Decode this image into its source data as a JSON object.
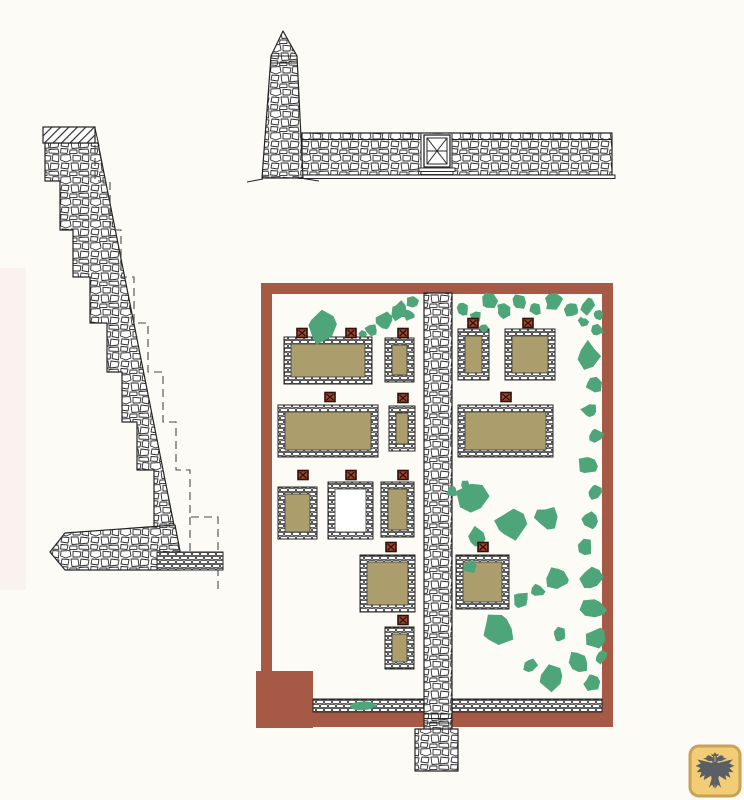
{
  "document": {
    "type": "archaeological measured drawing: walled garden site plan with wall elevation and stepped wall section",
    "visible_text": []
  },
  "colors": {
    "background": "#fcfbf5",
    "paper_tint_strip": "#f9f2ef",
    "line": "#242424",
    "perimeter_wall_red": "#a65a45",
    "building_fill_tan": "#ab9e6c",
    "building_fill_open": "#ffffff",
    "vegetation_green": "#4ea57a",
    "marker_fill": "#9e4730",
    "marker_border": "#30100a",
    "badge_fill": "#f2cd75",
    "badge_border": "#c7a258",
    "eagle": "#5a5f66",
    "dashed_line": "#4a4a4a"
  },
  "plan": {
    "perimeter": {
      "x0": 261,
      "y0": 283,
      "x1": 613,
      "y1": 727,
      "band": 11,
      "bottom_band": 15
    },
    "bastion": {
      "x": 256,
      "y": 671,
      "w": 57,
      "h": 57
    },
    "central_wall": {
      "x": 424,
      "y": 293,
      "w": 28,
      "h": 437
    },
    "wall_footing": {
      "x": 415,
      "y": 729,
      "w": 43,
      "h": 42
    },
    "bottom_strips": [
      {
        "x": 313,
        "y": 699,
        "w": 111,
        "h": 13
      },
      {
        "x": 452,
        "y": 699,
        "w": 150,
        "h": 13
      }
    ],
    "buildings": [
      {
        "x": 284,
        "y": 337,
        "w": 88,
        "h": 47,
        "fill": "tan"
      },
      {
        "x": 385,
        "y": 338,
        "w": 29,
        "h": 44,
        "fill": "tan"
      },
      {
        "x": 278,
        "y": 405,
        "w": 100,
        "h": 52,
        "fill": "tan"
      },
      {
        "x": 389,
        "y": 406,
        "w": 26,
        "h": 45,
        "fill": "tan"
      },
      {
        "x": 278,
        "y": 487,
        "w": 39,
        "h": 52,
        "fill": "tan"
      },
      {
        "x": 328,
        "y": 482,
        "w": 45,
        "h": 57,
        "fill": "open"
      },
      {
        "x": 381,
        "y": 482,
        "w": 33,
        "h": 55,
        "fill": "tan"
      },
      {
        "x": 360,
        "y": 555,
        "w": 55,
        "h": 57,
        "fill": "tan"
      },
      {
        "x": 385,
        "y": 627,
        "w": 29,
        "h": 42,
        "fill": "tan"
      },
      {
        "x": 458,
        "y": 329,
        "w": 31,
        "h": 51,
        "fill": "tan"
      },
      {
        "x": 505,
        "y": 329,
        "w": 50,
        "h": 51,
        "fill": "tan"
      },
      {
        "x": 458,
        "y": 405,
        "w": 95,
        "h": 52,
        "fill": "tan"
      },
      {
        "x": 456,
        "y": 555,
        "w": 53,
        "h": 54,
        "fill": "tan"
      }
    ],
    "markers": [
      [
        302,
        333
      ],
      [
        351,
        333
      ],
      [
        403,
        333
      ],
      [
        473,
        323
      ],
      [
        528,
        323
      ],
      [
        330,
        397
      ],
      [
        403,
        398
      ],
      [
        506,
        397
      ],
      [
        303,
        475
      ],
      [
        351,
        475
      ],
      [
        403,
        475
      ],
      [
        391,
        547
      ],
      [
        483,
        547
      ],
      [
        403,
        620
      ]
    ],
    "vegetation": [
      [
        321,
        327,
        15,
        1
      ],
      [
        371,
        330,
        6,
        2
      ],
      [
        384,
        321,
        10,
        3
      ],
      [
        400,
        311,
        9,
        4
      ],
      [
        412,
        301,
        6,
        5
      ],
      [
        363,
        334,
        4,
        6
      ],
      [
        409,
        315,
        6,
        7
      ],
      [
        463,
        309,
        6,
        8
      ],
      [
        476,
        318,
        6,
        9
      ],
      [
        489,
        302,
        8,
        10
      ],
      [
        503,
        311,
        7,
        11
      ],
      [
        484,
        328,
        5,
        12
      ],
      [
        519,
        301,
        9,
        13
      ],
      [
        536,
        308,
        6,
        14
      ],
      [
        553,
        301,
        9,
        15
      ],
      [
        571,
        310,
        7,
        16
      ],
      [
        588,
        306,
        8,
        17
      ],
      [
        599,
        315,
        5,
        18
      ],
      [
        583,
        322,
        5,
        19
      ],
      [
        597,
        331,
        6,
        20
      ],
      [
        588,
        356,
        13,
        21
      ],
      [
        594,
        384,
        9,
        22
      ],
      [
        590,
        411,
        8,
        23
      ],
      [
        596,
        435,
        7,
        24
      ],
      [
        588,
        465,
        9,
        25
      ],
      [
        595,
        493,
        7,
        26
      ],
      [
        591,
        520,
        8,
        27
      ],
      [
        585,
        547,
        8,
        28
      ],
      [
        472,
        500,
        15,
        29
      ],
      [
        511,
        523,
        15,
        30
      ],
      [
        547,
        518,
        11,
        31
      ],
      [
        477,
        538,
        10,
        32
      ],
      [
        452,
        492,
        6,
        33
      ],
      [
        556,
        577,
        11,
        34
      ],
      [
        592,
        578,
        11,
        35
      ],
      [
        470,
        567,
        7,
        36
      ],
      [
        465,
        485,
        5,
        50
      ],
      [
        499,
        628,
        15,
        37
      ],
      [
        560,
        635,
        7,
        38
      ],
      [
        593,
        608,
        12,
        39
      ],
      [
        596,
        639,
        10,
        41
      ],
      [
        578,
        663,
        11,
        42
      ],
      [
        554,
        678,
        12,
        43
      ],
      [
        530,
        665,
        7,
        44
      ],
      [
        592,
        683,
        8,
        45
      ],
      [
        601,
        657,
        6,
        46
      ],
      [
        521,
        600,
        8,
        47
      ],
      [
        537,
        590,
        7,
        48
      ],
      [
        363,
        706,
        13,
        49,
        0.45
      ]
    ]
  },
  "badge": {
    "x": 690,
    "y": 746,
    "size": 50,
    "icon": "double-headed-eagle"
  }
}
